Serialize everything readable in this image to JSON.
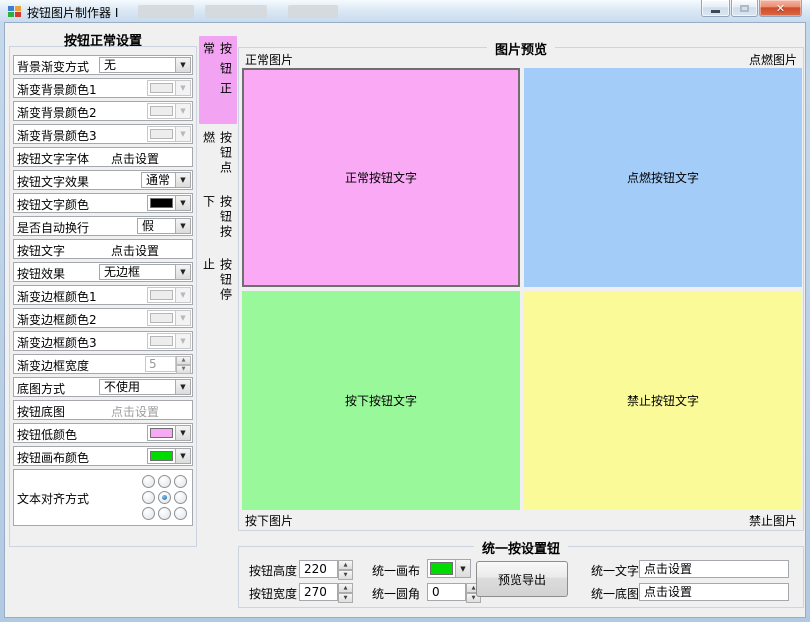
{
  "window": {
    "title": "按钮图片制作器 I",
    "controls": {
      "minimize": "minimize",
      "maximize": "maximize",
      "close": "close"
    }
  },
  "left_panel": {
    "title": "按钮正常设置",
    "rows": [
      {
        "label": "背景渐变方式",
        "value": "无",
        "type": "combo",
        "enabled": true
      },
      {
        "label": "渐变背景颜色1",
        "type": "color",
        "color": "#EDEDED",
        "enabled": false
      },
      {
        "label": "渐变背景颜色2",
        "type": "color",
        "color": "#EDEDED",
        "enabled": false
      },
      {
        "label": "渐变背景颜色3",
        "type": "color",
        "color": "#EDEDED",
        "enabled": false
      },
      {
        "label": "按钮文字字体",
        "value": "点击设置",
        "type": "link",
        "enabled": true
      },
      {
        "label": "按钮文字效果",
        "value": "通常",
        "type": "combo",
        "enabled": true
      },
      {
        "label": "按钮文字颜色",
        "type": "color",
        "color": "#000000",
        "enabled": true
      },
      {
        "label": "是否自动换行",
        "value": "假",
        "type": "combo",
        "enabled": true
      },
      {
        "label": "按钮文字",
        "value": "点击设置",
        "type": "link",
        "enabled": true
      },
      {
        "label": "按钮效果",
        "value": "无边框",
        "type": "combo",
        "enabled": true
      },
      {
        "label": "渐变边框颜色1",
        "type": "color",
        "color": "#EDEDED",
        "enabled": false
      },
      {
        "label": "渐变边框颜色2",
        "type": "color",
        "color": "#EDEDED",
        "enabled": false
      },
      {
        "label": "渐变边框颜色3",
        "type": "color",
        "color": "#EDEDED",
        "enabled": false
      },
      {
        "label": "渐变边框宽度",
        "value": "5",
        "type": "spinner",
        "enabled": false
      },
      {
        "label": "底图方式",
        "value": "不使用",
        "type": "combo",
        "enabled": true
      },
      {
        "label": "按钮底图",
        "value": "点击设置",
        "type": "link",
        "enabled": false
      },
      {
        "label": "按钮低颜色",
        "type": "color",
        "color": "#F6AAF6",
        "enabled": true
      },
      {
        "label": "按钮画布颜色",
        "type": "color",
        "color": "#00DC00",
        "enabled": true
      },
      {
        "label": "文本对齐方式",
        "type": "radio-grid",
        "selected_index": 4
      }
    ]
  },
  "tabs": {
    "items": [
      "按钮正常",
      "按钮点燃",
      "按钮按下",
      "按钮停止"
    ],
    "selected": 0,
    "selected_color": "#F2A4F2"
  },
  "preview": {
    "title": "图片预览",
    "labels": {
      "top_left": "正常图片",
      "top_right": "点燃图片",
      "bottom_left": "按下图片",
      "bottom_right": "禁止图片"
    },
    "quadrants": [
      {
        "text": "正常按钮文字",
        "color": "#FAAAF5"
      },
      {
        "text": "点燃按钮文字",
        "color": "#A3CDF8"
      },
      {
        "text": "按下按钮文字",
        "color": "#99F899"
      },
      {
        "text": "禁止按钮文字",
        "color": "#FAFA99"
      }
    ]
  },
  "bottom_panel": {
    "title": "统一按设置钮",
    "height": {
      "label": "按钮高度",
      "value": "220"
    },
    "width": {
      "label": "按钮宽度",
      "value": "270"
    },
    "canvas": {
      "label": "统一画布",
      "color": "#00DC00"
    },
    "radius": {
      "label": "统一圆角",
      "value": "0"
    },
    "export_button": "预览导出",
    "unified_text": {
      "label": "统一文字",
      "value": "点击设置"
    },
    "unified_base": {
      "label": "统一底图",
      "value": "点击设置"
    }
  }
}
